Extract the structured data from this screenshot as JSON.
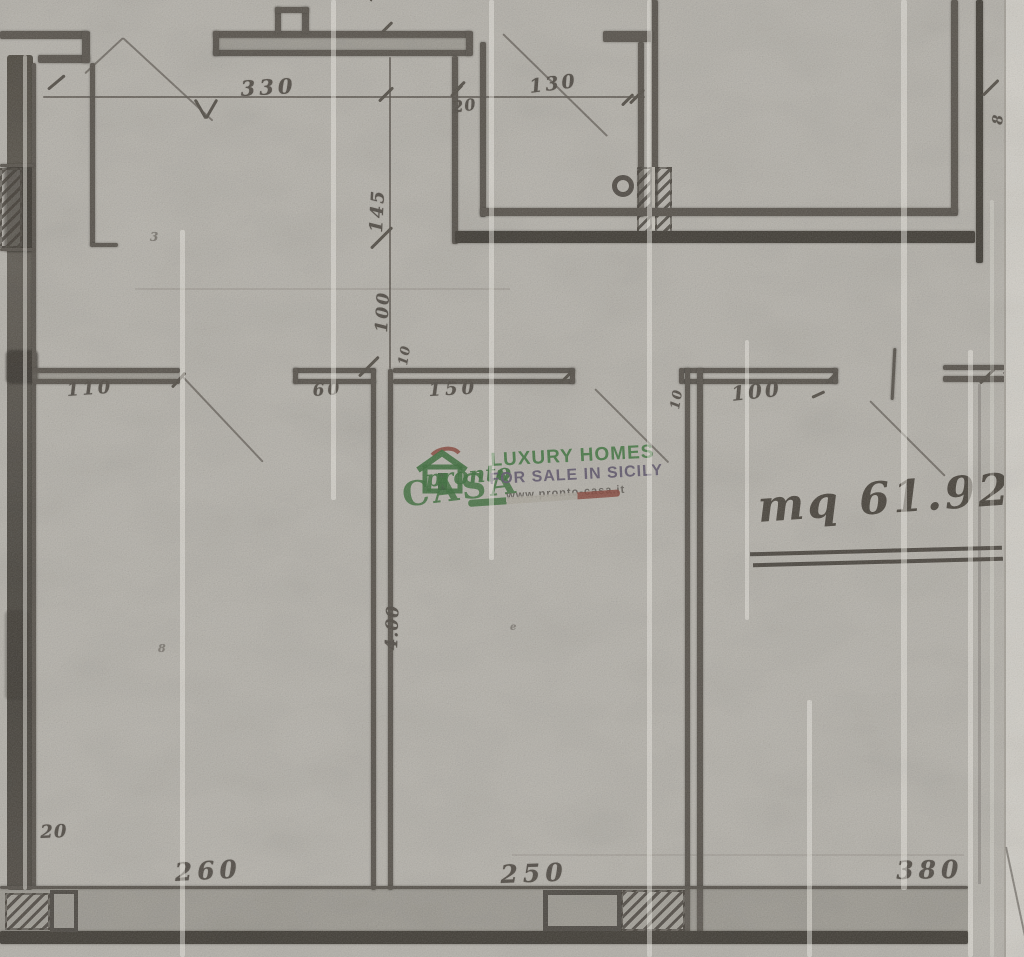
{
  "watermark": {
    "script": "pronto",
    "caps": "CASA",
    "tagline1": "LUXURY HOMES",
    "tagline2": "FOR SALE IN SICILY",
    "website": "www.pronto-casa.it",
    "colors": {
      "green": "#3a8c3e",
      "purple": "#786c94",
      "red": "#b2493a",
      "white": "#efece5"
    }
  },
  "area_note": "mq 61.92",
  "dims": {
    "cut_a": "1",
    "cut_b": "2",
    "rot20_top": "20",
    "d330": "330",
    "d130": "130",
    "d20_wall": "20",
    "d8_right": "8",
    "d145": "145",
    "d100_vert": "100",
    "d10_vert": "10",
    "d110": "110",
    "d60": "60",
    "d150": "150",
    "d10_corner": "10",
    "d100_horiz": "100",
    "d400": "4.00",
    "d20_bottom": "20",
    "d260": "260",
    "d250": "250",
    "d380": "380"
  },
  "marks": {
    "speck_a": "3",
    "speck_b": "8",
    "speck_c": "e"
  }
}
